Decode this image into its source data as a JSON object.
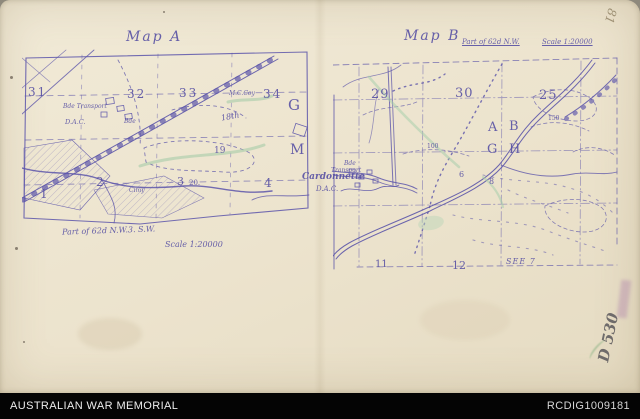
{
  "map_a": {
    "title": "Map A",
    "n31": "31",
    "n32": "32",
    "n33": "33",
    "n34": "34",
    "mccoy": "M.C.Coy",
    "n18th": "18th",
    "n19": "19",
    "g": "G",
    "m": "M",
    "n1": "1",
    "n2": "2",
    "n3": "3",
    "n20": "20.",
    "n4": "4",
    "cimy": "Cimy",
    "bde": "Bde",
    "unit1": "Bde Transport",
    "unit2": "D.A.C.",
    "caption_sheet": "Part of 62d N.W.3. S.W.",
    "caption_scale": "Scale 1:20000"
  },
  "map_b": {
    "title": "Map B",
    "header_sheet": "Part of 62d N.W.",
    "header_scale": "Scale 1:20000",
    "n29": "29",
    "n30": "30",
    "n25": "25",
    "a": "A",
    "b": "B",
    "g": "G",
    "h": "H",
    "c100": "100",
    "c150": "150",
    "bde1": "Bde",
    "bde2": "Transport",
    "place": "Cardonnette",
    "dac": "D.A.C.",
    "n6": "6",
    "n8": "8",
    "n11": "11",
    "n12": "12",
    "see7": "SEE 7"
  },
  "marks": {
    "corner": "81",
    "pencil": "D 530"
  },
  "footer": {
    "org": "AUSTRALIAN WAR MEMORIAL",
    "id": "RCDIG1009181"
  },
  "colors": {
    "ink": "#5c55aa",
    "green": "#a6cba8",
    "paper": "#ece4cf",
    "footer_bg": "#000000"
  }
}
